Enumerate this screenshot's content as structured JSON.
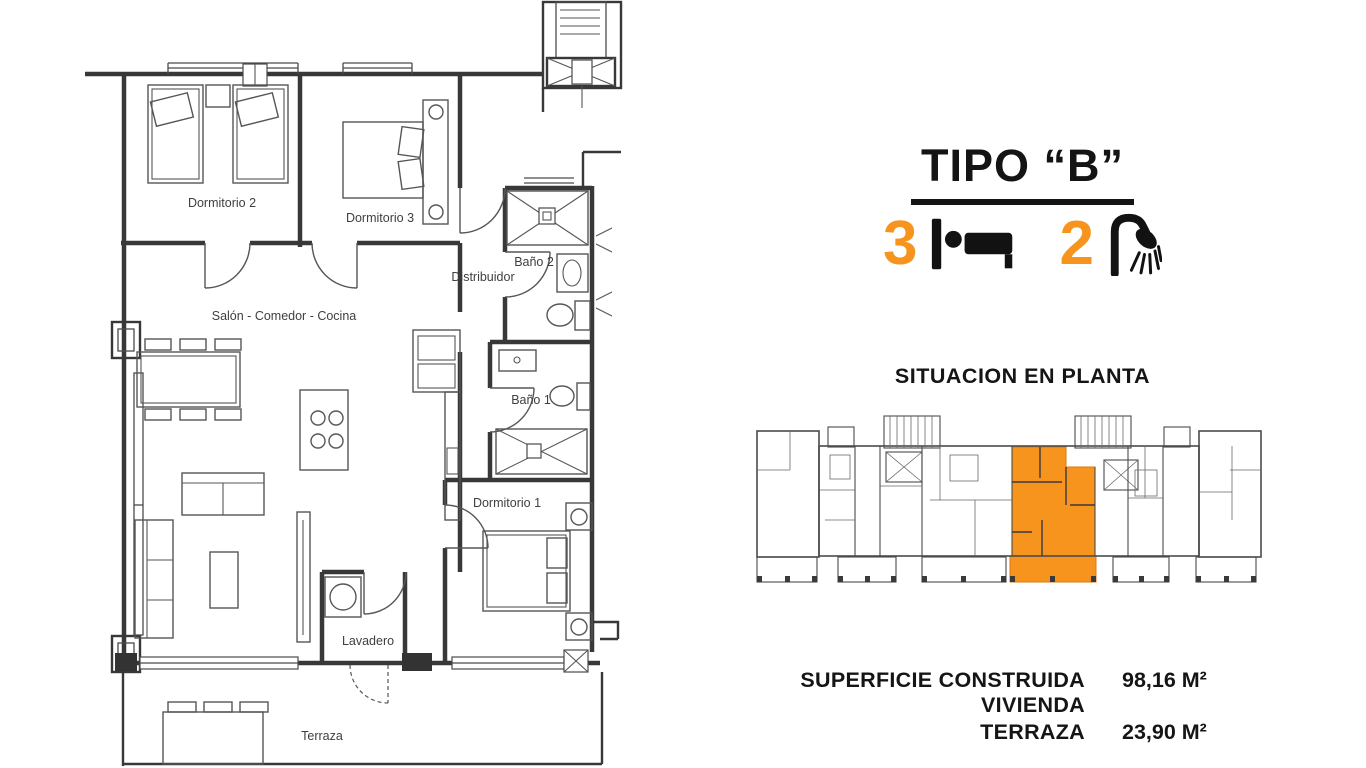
{
  "floor_plan": {
    "rooms": {
      "dormitorio2": "Dormitorio 2",
      "dormitorio3": "Dormitorio 3",
      "bano2": "Baño 2",
      "distribuidor": "Distribuidor",
      "salon": "Salón - Comedor - Cocina",
      "bano1": "Baño 1",
      "dormitorio1": "Dormitorio 1",
      "lavadero": "Lavadero",
      "terraza": "Terraza"
    }
  },
  "info_panel": {
    "title": "TIPO “B”",
    "bedrooms_count": "3",
    "bathrooms_count": "2",
    "bed_icon": "bed-icon",
    "shower_icon": "shower-icon",
    "situacion_title": "SITUACION EN PLANTA",
    "areas": [
      {
        "label": "SUPERFICIE CONSTRUIDA VIVIENDA",
        "value": "98,16 M²"
      },
      {
        "label": "TERRAZA",
        "value": "23,90 M²"
      }
    ]
  },
  "colors": {
    "accent_orange": "#F7941E",
    "plan_line": "#3F3F3F",
    "text_black": "#141414"
  }
}
